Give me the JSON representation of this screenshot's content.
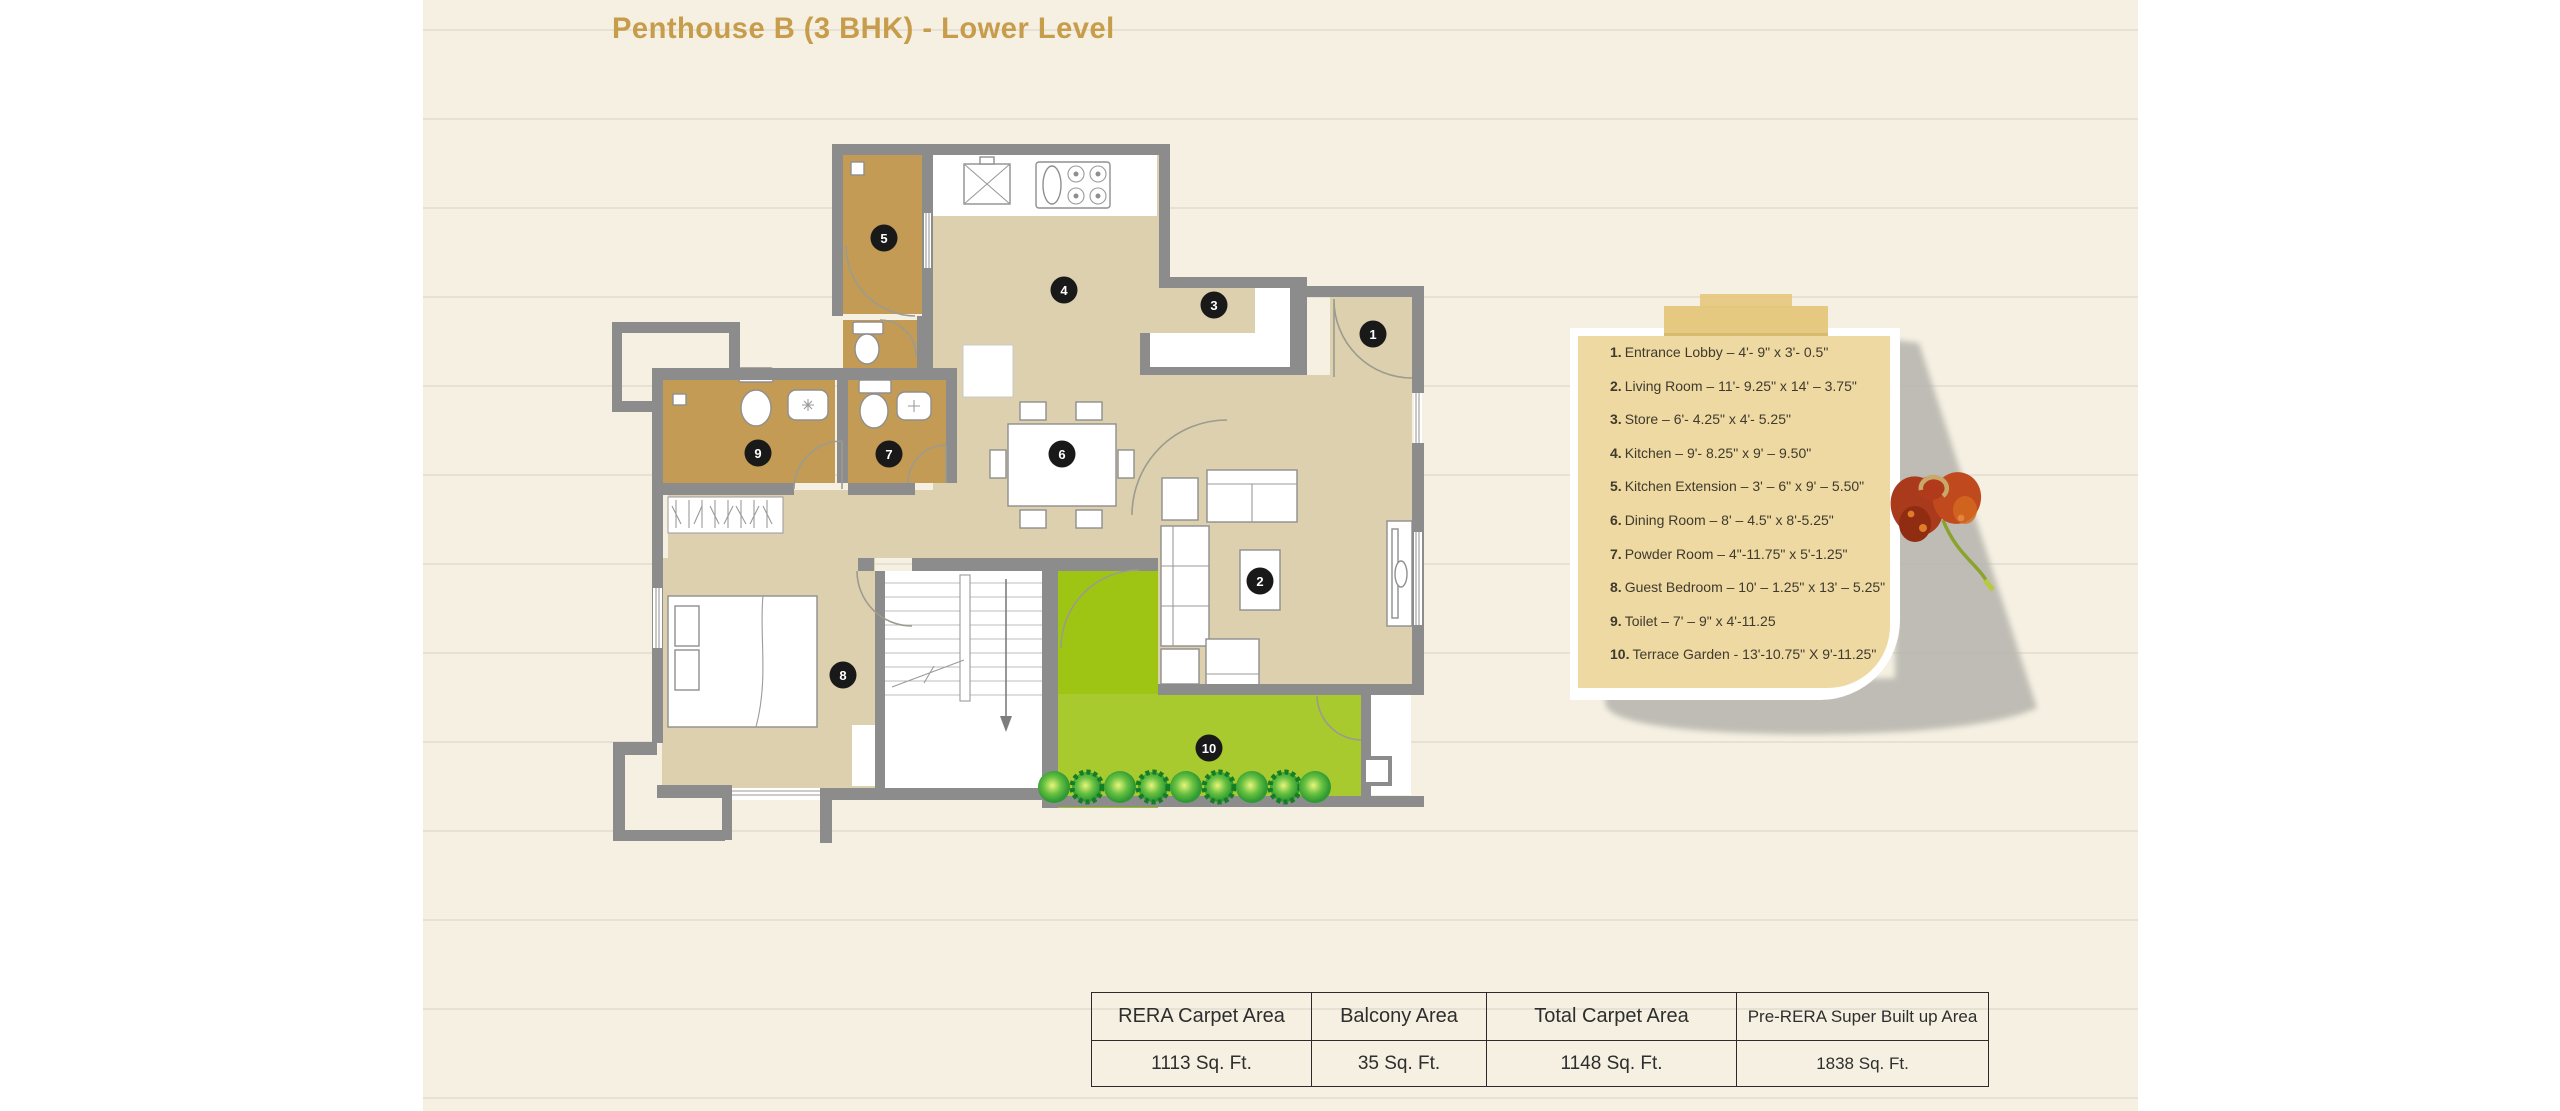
{
  "title": "Penthouse B (3 BHK) - Lower Level",
  "colors": {
    "title_gold": "#c79c4b",
    "paper_cream": "#f5f0e2",
    "wall_gray": "#8c8c8c",
    "floor_beige": "#ddd0ae",
    "wet_area_tan": "#c39b55",
    "terrace_green": "#a8ca2e",
    "note_card_tan": "#eed9a2",
    "badge_black": "#191919"
  },
  "legend": {
    "items": [
      {
        "num": "1.",
        "text": "Entrance Lobby – 4'- 9\" x 3'- 0.5\""
      },
      {
        "num": "2.",
        "text": "Living Room – 11'- 9.25\" x 14' – 3.75\""
      },
      {
        "num": "3.",
        "text": "Store – 6'- 4.25\" x 4'- 5.25\""
      },
      {
        "num": "4.",
        "text": "Kitchen – 9'- 8.25\" x 9' – 9.50\""
      },
      {
        "num": "5.",
        "text": "Kitchen Extension – 3' – 6\" x 9' – 5.50\""
      },
      {
        "num": "6.",
        "text": "Dining Room – 8' – 4.5\" x 8'-5.25\""
      },
      {
        "num": "7.",
        "text": "Powder Room – 4\"-11.75\" x 5'-1.25\""
      },
      {
        "num": "8.",
        "text": "Guest Bedroom – 10' – 1.25\" x 13' – 5.25\""
      },
      {
        "num": "9.",
        "text": "Toilet – 7' – 9\" x 4'-11.25"
      },
      {
        "num": "10.",
        "text": "Terrace Garden - 13'-10.75\" X 9'-11.25\""
      }
    ]
  },
  "plan": {
    "badges": [
      {
        "n": "1",
        "x": 761,
        "y": 196
      },
      {
        "n": "2",
        "x": 648,
        "y": 443
      },
      {
        "n": "3",
        "x": 602,
        "y": 167
      },
      {
        "n": "4",
        "x": 452,
        "y": 152
      },
      {
        "n": "5",
        "x": 272,
        "y": 100
      },
      {
        "n": "6",
        "x": 450,
        "y": 316
      },
      {
        "n": "7",
        "x": 277,
        "y": 316
      },
      {
        "n": "8",
        "x": 231,
        "y": 537
      },
      {
        "n": "9",
        "x": 146,
        "y": 315
      },
      {
        "n": "10",
        "x": 597,
        "y": 610
      }
    ]
  },
  "table": {
    "headers": [
      "RERA Carpet Area",
      "Balcony Area",
      "Total Carpet Area",
      "Pre-RERA Super Built up Area"
    ],
    "values": [
      "1113 Sq. Ft.",
      "35 Sq. Ft.",
      "1148 Sq. Ft.",
      "1838 Sq. Ft."
    ]
  }
}
